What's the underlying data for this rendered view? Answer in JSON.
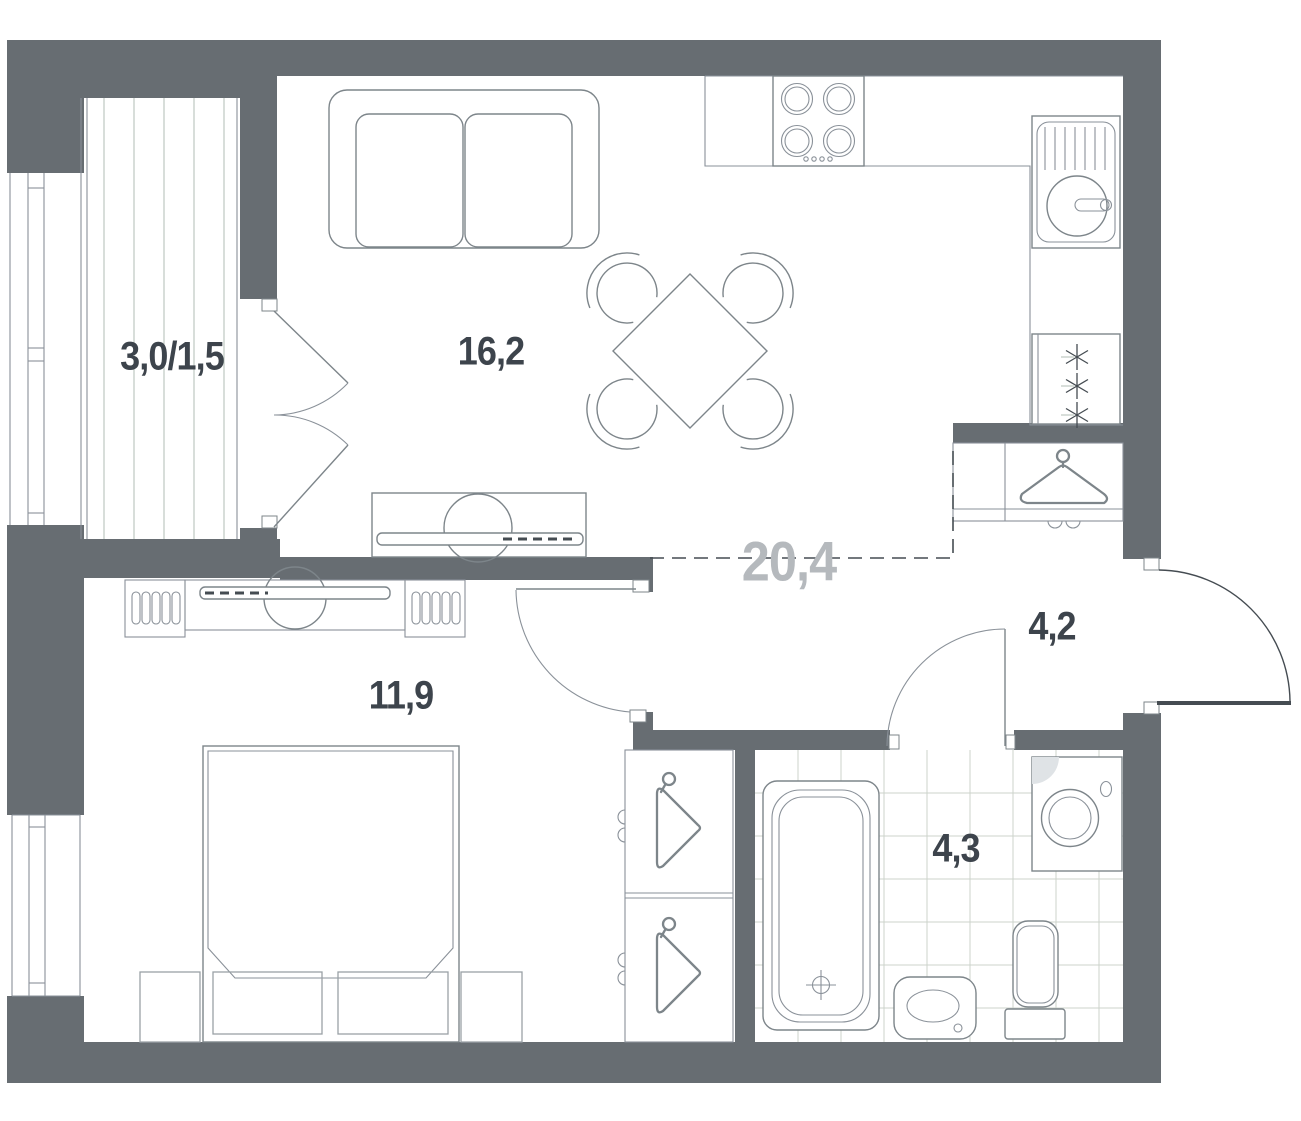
{
  "title": "One-bedroom apartment floor plan",
  "colors": {
    "wall": "#676d72",
    "furn": "#7d858a",
    "line": "#8a9199",
    "soft": "#9aa1a6",
    "light": "#b9c3bc",
    "tile": "#ccd3cb",
    "dark": "#454c52",
    "label": "#3d444c",
    "label_muted": "#b5b9bd"
  },
  "rooms": {
    "balcony": {
      "name": "balcony",
      "area_label": "3,0/1,5"
    },
    "living_kitchen": {
      "name": "living-kitchen",
      "area_label": "16,2"
    },
    "living_kitchen_total": {
      "name": "combined-area-total",
      "area_label": "20,4"
    },
    "bedroom": {
      "name": "bedroom",
      "area_label": "11,9"
    },
    "hallway": {
      "name": "hallway",
      "area_label": "4,2"
    },
    "bathroom": {
      "name": "bathroom",
      "area_label": "4,3"
    }
  },
  "fixtures": [
    "sofa",
    "dining-table",
    "dining-chairs",
    "tv-console-living",
    "cooktop",
    "kitchen-sink",
    "refrigerator",
    "hallway-wardrobe-hanger",
    "entrance-door",
    "bedroom-door",
    "bathroom-door",
    "balcony-french-doors",
    "bedroom-tv-unit",
    "double-bed",
    "nightstands",
    "bedroom-wardrobe-hangers",
    "bathtub",
    "washing-machine",
    "toilet",
    "washbasin"
  ]
}
